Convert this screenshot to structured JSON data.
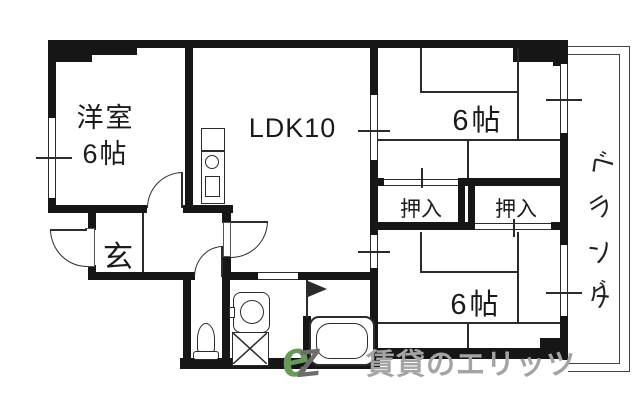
{
  "rooms": {
    "western": {
      "name": "洋室",
      "size": "6帖"
    },
    "ldk": {
      "label": "LDK10"
    },
    "bedroom_upper": {
      "size": "6帖"
    },
    "bedroom_lower": {
      "size": "6帖"
    },
    "closet_left": {
      "label": "押入"
    },
    "closet_right": {
      "label": "押入"
    },
    "entrance": {
      "label": "玄"
    },
    "veranda": {
      "label": "ベランダ",
      "chars": [
        "ベ",
        "ラ",
        "ン",
        "ダ"
      ]
    }
  },
  "watermark": {
    "text": "賃貸のエリッツ",
    "logo_glyphs": [
      "e",
      "Z"
    ]
  },
  "icons": {
    "kitchen": "kitchen-counter-icon",
    "burner": "burner-circle-icon",
    "toilet": "toilet-icon",
    "washbasin": "washbasin-icon",
    "washer_pan": "washing-machine-pan-icon",
    "bathtub": "bathtub-icon",
    "bath_door": "folding-door-flag-icon",
    "swing_door": "swing-door-arc",
    "window": "sliding-window-lines"
  },
  "colors": {
    "wall": "#161616",
    "line": "#2b2b2b",
    "watermark": "#a4a4a4",
    "logo_green": "#69985c"
  }
}
